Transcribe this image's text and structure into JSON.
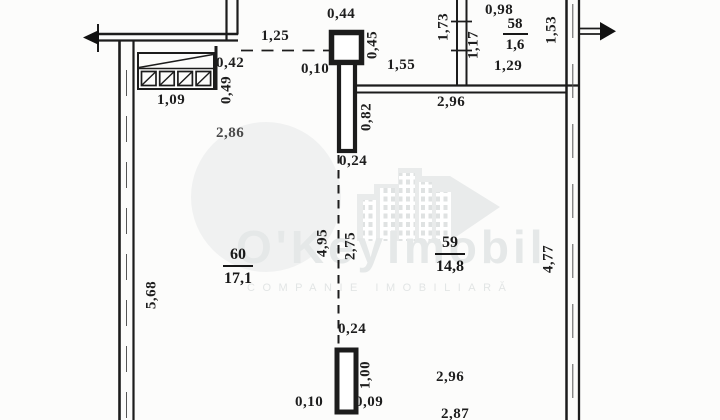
{
  "watermark": {
    "brand": "O'KeyImobil",
    "tagline": "COMPANIE IMOBILIARĂ"
  },
  "rooms": {
    "r60": {
      "number": "60",
      "area": "17,1"
    },
    "r59": {
      "number": "59",
      "area": "14,8"
    },
    "r58": {
      "number": "58",
      "area": "1,6"
    }
  },
  "dims": {
    "pillar_width": "0,44",
    "opening_left": "1,25",
    "niche_width": "0,42",
    "gap_pillar_left": "0,10",
    "pillar_depth": "0,45",
    "opening_hall": "1,55",
    "room58_width": "0,98",
    "niche_length": "1,09",
    "niche_depth": "0,49",
    "stub_top": "0,82",
    "room58_wall_left": "1,73",
    "room58_wall_inner": "1,17",
    "room58_wall_right": "1,53",
    "room58_length": "1,29",
    "hall_span": "2,96",
    "room60_top_span": "2,86",
    "divider_gap_top": "0,24",
    "divider_left": "4,95",
    "divider_right": "2,75",
    "divider_gap_bottom": "0,24",
    "room60_left_wall": "5,68",
    "room59_right_wall": "4,77",
    "stub_bottom": "1,00",
    "gap_bottom_left": "0,10",
    "gap_bottom_right": "0,09",
    "room59_bottom_span": "2,96",
    "bottom_cut_span": "2,87"
  }
}
